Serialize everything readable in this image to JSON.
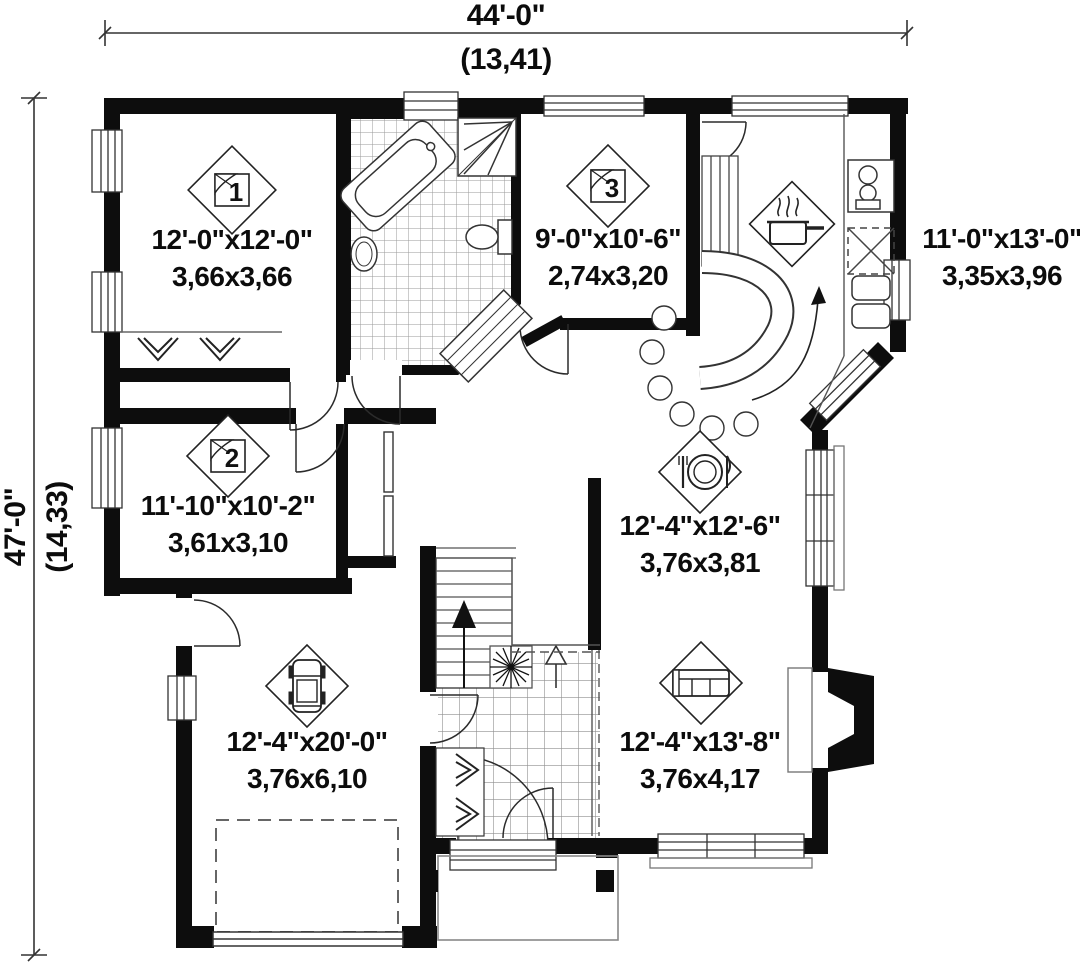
{
  "title": "House first-floor plan",
  "dimensions": {
    "width_feet": "44'-0\"",
    "width_meters": "(13,41)",
    "height_feet": "47'-0\"",
    "height_meters": "(14,33)"
  },
  "rooms": [
    {
      "id": "bedroom-1",
      "icon": "bed-icon",
      "number": "1",
      "size_imperial": "12'-0\"x12'-0\"",
      "size_metric": "3,66x3,66"
    },
    {
      "id": "bedroom-2",
      "icon": "bed-icon",
      "number": "2",
      "size_imperial": "11'-10\"x10'-2\"",
      "size_metric": "3,61x3,10"
    },
    {
      "id": "bedroom-3",
      "icon": "bed-icon",
      "number": "3",
      "size_imperial": "9'-0\"x10'-6\"",
      "size_metric": "2,74x3,20"
    },
    {
      "id": "kitchen",
      "icon": "cooking-pot-icon",
      "number": "",
      "size_imperial": "11'-0\"x13'-0\"",
      "size_metric": "3,35x3,96"
    },
    {
      "id": "dining",
      "icon": "plate-cutlery-icon",
      "number": "",
      "size_imperial": "12'-4\"x12'-6\"",
      "size_metric": "3,76x3,81"
    },
    {
      "id": "living",
      "icon": "sofa-icon",
      "number": "",
      "size_imperial": "12'-4\"x13'-8\"",
      "size_metric": "3,76x4,17"
    },
    {
      "id": "garage",
      "icon": "car-icon",
      "number": "",
      "size_imperial": "12'-4\"x20'-0\"",
      "size_metric": "3,76x6,10"
    }
  ],
  "colors": {
    "wall": "#0d0d0d",
    "line": "#333333",
    "tile": "#9a9a9a",
    "background": "#ffffff"
  }
}
